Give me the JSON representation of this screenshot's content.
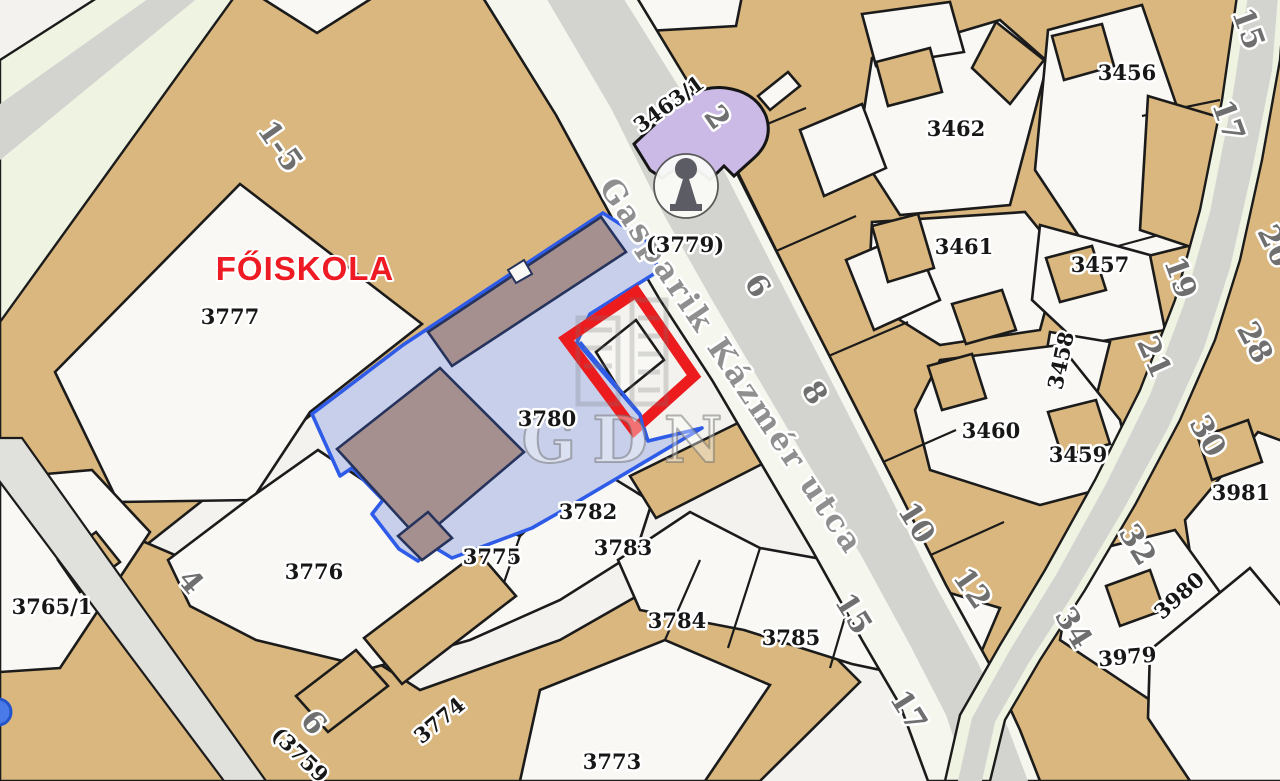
{
  "map": {
    "title": "FŐISKOLA cadastral map detail",
    "poi_label": "FŐISKOLA",
    "street_name": "Gasparik Kázmér utca",
    "watermark_text": "GDN",
    "highlights": {
      "blue_parcel": {
        "label": "3780",
        "fill": "#c7cfeb",
        "stroke": "#2e5be8"
      },
      "red_outline": {
        "stroke": "#ec1b1e"
      }
    },
    "colors": {
      "block_tan": "#d9b77e",
      "parcel_white": "#f9f8f5",
      "street_gray": "#d3d3d0",
      "street_green": "#eef3e2",
      "church_purple": "#cbb9e6",
      "inner_building_mauve": "#a5908f",
      "label_black": "#171717",
      "label_gray": "#6f6f6f",
      "poi_red": "#ee1b24",
      "boundary_black": "#1b1b1b"
    },
    "labels": [
      {
        "name": "poi-foiskola",
        "text": "FŐISKOLA",
        "x": 305,
        "y": 280,
        "rot": 0,
        "size": 33,
        "type": "poi"
      },
      {
        "name": "street-name",
        "text": "Gasparik Kázmér utca",
        "x": 723,
        "y": 372,
        "rot": 56,
        "size": 31,
        "type": "street"
      },
      {
        "name": "watermark-text",
        "text": "GDN",
        "x": 630,
        "y": 462,
        "rot": 0,
        "size": 64,
        "type": "watermark"
      },
      {
        "name": "parcel-label-3777",
        "text": "3777",
        "x": 230,
        "y": 324,
        "rot": 0,
        "size": 22,
        "type": "parcel"
      },
      {
        "name": "parcel-label-3780",
        "text": "3780",
        "x": 547,
        "y": 426,
        "rot": 0,
        "size": 25,
        "type": "parcel"
      },
      {
        "name": "parcel-label-3782",
        "text": "3782",
        "x": 588,
        "y": 519,
        "rot": 0,
        "size": 21,
        "type": "parcel"
      },
      {
        "name": "parcel-label-3783",
        "text": "3783",
        "x": 623,
        "y": 555,
        "rot": 0,
        "size": 21,
        "type": "parcel"
      },
      {
        "name": "parcel-label-3784",
        "text": "3784",
        "x": 677,
        "y": 628,
        "rot": 0,
        "size": 21,
        "type": "parcel"
      },
      {
        "name": "parcel-label-3785",
        "text": "3785",
        "x": 791,
        "y": 645,
        "rot": 0,
        "size": 21,
        "type": "parcel"
      },
      {
        "name": "parcel-label-3775",
        "text": "3775",
        "x": 492,
        "y": 564,
        "rot": 0,
        "size": 21,
        "type": "parcel"
      },
      {
        "name": "parcel-label-3776",
        "text": "3776",
        "x": 314,
        "y": 579,
        "rot": 0,
        "size": 21,
        "type": "parcel"
      },
      {
        "name": "parcel-label-3774",
        "text": "3774",
        "x": 444,
        "y": 726,
        "rot": -40,
        "size": 21,
        "type": "parcel"
      },
      {
        "name": "parcel-label-3773",
        "text": "3773",
        "x": 612,
        "y": 769,
        "rot": 0,
        "size": 21,
        "type": "parcel"
      },
      {
        "name": "parcel-label-3765-1",
        "text": "3765/1",
        "x": 52,
        "y": 614,
        "rot": 0,
        "size": 19,
        "type": "parcel"
      },
      {
        "name": "parcel-label-3463-1",
        "text": "3463/1",
        "x": 673,
        "y": 110,
        "rot": -36,
        "size": 20,
        "type": "parcel"
      },
      {
        "name": "parcel-label-3779",
        "text": "(3779)",
        "x": 685,
        "y": 252,
        "rot": 0,
        "size": 22,
        "type": "parcel"
      },
      {
        "name": "parcel-label-3759",
        "text": "(3759",
        "x": 295,
        "y": 760,
        "rot": 44,
        "size": 20,
        "type": "parcel"
      },
      {
        "name": "parcel-label-3462",
        "text": "3462",
        "x": 956,
        "y": 136,
        "rot": 0,
        "size": 22,
        "type": "parcel"
      },
      {
        "name": "parcel-label-3456",
        "text": "3456",
        "x": 1127,
        "y": 80,
        "rot": 0,
        "size": 22,
        "type": "parcel"
      },
      {
        "name": "parcel-label-3461",
        "text": "3461",
        "x": 964,
        "y": 254,
        "rot": 0,
        "size": 22,
        "type": "parcel"
      },
      {
        "name": "parcel-label-3457",
        "text": "3457",
        "x": 1100,
        "y": 272,
        "rot": 0,
        "size": 22,
        "type": "parcel"
      },
      {
        "name": "parcel-label-3458",
        "text": "3458",
        "x": 1068,
        "y": 362,
        "rot": -78,
        "size": 21,
        "type": "parcel"
      },
      {
        "name": "parcel-label-3460",
        "text": "3460",
        "x": 991,
        "y": 438,
        "rot": 0,
        "size": 22,
        "type": "parcel"
      },
      {
        "name": "parcel-label-3459",
        "text": "3459",
        "x": 1078,
        "y": 462,
        "rot": 0,
        "size": 22,
        "type": "parcel"
      },
      {
        "name": "parcel-label-3981",
        "text": "3981",
        "x": 1241,
        "y": 500,
        "rot": 0,
        "size": 22,
        "type": "parcel"
      },
      {
        "name": "parcel-label-3980",
        "text": "3980",
        "x": 1184,
        "y": 601,
        "rot": -42,
        "size": 21,
        "type": "parcel"
      },
      {
        "name": "parcel-label-3979",
        "text": "3979",
        "x": 1128,
        "y": 664,
        "rot": -5,
        "size": 21,
        "type": "parcel"
      },
      {
        "name": "house-number-1-5",
        "text": "1-5",
        "x": 272,
        "y": 152,
        "rot": 55,
        "size": 38,
        "type": "house"
      },
      {
        "name": "house-number-2",
        "text": "2",
        "x": 709,
        "y": 123,
        "rot": 55,
        "size": 30,
        "type": "house"
      },
      {
        "name": "house-number-6",
        "text": "6",
        "x": 749,
        "y": 291,
        "rot": 58,
        "size": 30,
        "type": "house"
      },
      {
        "name": "house-number-8",
        "text": "8",
        "x": 806,
        "y": 398,
        "rot": 58,
        "size": 30,
        "type": "house"
      },
      {
        "name": "house-number-10",
        "text": "10",
        "x": 908,
        "y": 528,
        "rot": 58,
        "size": 30,
        "type": "house"
      },
      {
        "name": "house-number-12",
        "text": "12",
        "x": 964,
        "y": 594,
        "rot": 55,
        "size": 30,
        "type": "house"
      },
      {
        "name": "house-number-15",
        "text": "15",
        "x": 845,
        "y": 619,
        "rot": 58,
        "size": 32,
        "type": "house"
      },
      {
        "name": "house-number-17",
        "text": "17",
        "x": 900,
        "y": 716,
        "rot": 58,
        "size": 32,
        "type": "house"
      },
      {
        "name": "house-number-15-top",
        "text": "15",
        "x": 1239,
        "y": 32,
        "rot": 70,
        "size": 30,
        "type": "house"
      },
      {
        "name": "house-number-17-top",
        "text": "17",
        "x": 1219,
        "y": 124,
        "rot": 70,
        "size": 32,
        "type": "house"
      },
      {
        "name": "house-number-19",
        "text": "19",
        "x": 1171,
        "y": 281,
        "rot": 70,
        "size": 30,
        "type": "house"
      },
      {
        "name": "house-number-21",
        "text": "21",
        "x": 1145,
        "y": 361,
        "rot": 66,
        "size": 30,
        "type": "house"
      },
      {
        "name": "house-number-26",
        "text": "26",
        "x": 1266,
        "y": 250,
        "rot": 64,
        "size": 30,
        "type": "house"
      },
      {
        "name": "house-number-28",
        "text": "28",
        "x": 1246,
        "y": 347,
        "rot": 62,
        "size": 30,
        "type": "house"
      },
      {
        "name": "house-number-30",
        "text": "30",
        "x": 1199,
        "y": 441,
        "rot": 60,
        "size": 30,
        "type": "house"
      },
      {
        "name": "house-number-32",
        "text": "32",
        "x": 1129,
        "y": 550,
        "rot": 58,
        "size": 30,
        "type": "house"
      },
      {
        "name": "house-number-34",
        "text": "34",
        "x": 1065,
        "y": 633,
        "rot": 58,
        "size": 30,
        "type": "house"
      },
      {
        "name": "house-number-4",
        "text": "4",
        "x": 183,
        "y": 588,
        "rot": 50,
        "size": 27,
        "type": "house"
      },
      {
        "name": "house-number-6b",
        "text": "6",
        "x": 306,
        "y": 729,
        "rot": 50,
        "size": 27,
        "type": "house"
      }
    ]
  }
}
